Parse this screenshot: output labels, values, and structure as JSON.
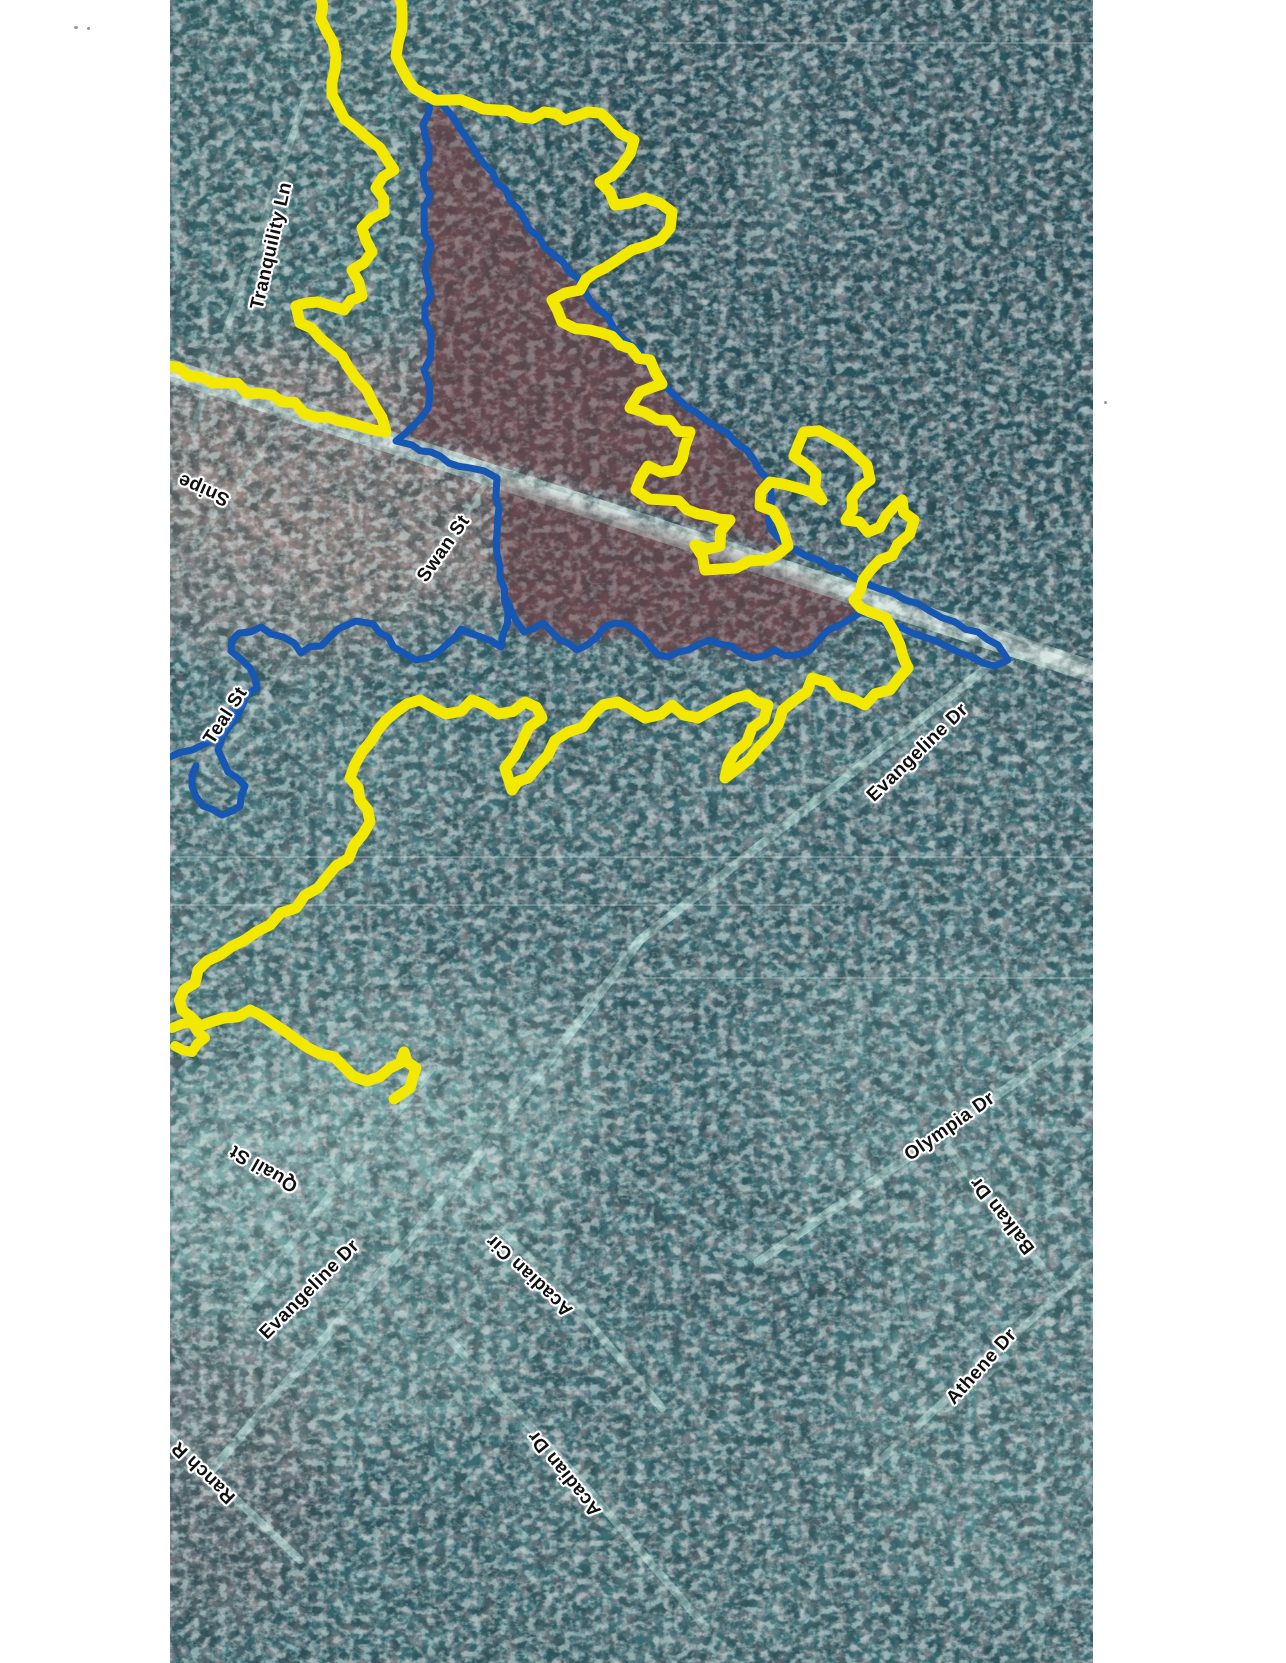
{
  "page": {
    "background": "#ffffff"
  },
  "map": {
    "area": {
      "left": 170,
      "top": 0,
      "width": 923,
      "height": 1663
    },
    "colors": {
      "outer_boundary_yellow": "#f3e800",
      "inner_boundary_blue": "#1557b2",
      "base_teal": "#33626a",
      "dark_forest": "#26505a",
      "burn_region_brown": "#6b4a50",
      "road_light": "#b7cec9",
      "road_bright": "#d9e6e1",
      "label_text": "#101010",
      "label_halo": "#ffffff"
    },
    "street_labels": [
      {
        "id": "tranquility-ln",
        "text": "Tranquility Ln",
        "x": 272,
        "y": 246,
        "rot": -77
      },
      {
        "id": "snipe",
        "text": "Snipe",
        "x": 204,
        "y": 489,
        "rot": -156
      },
      {
        "id": "swan-st",
        "text": "Swan St",
        "x": 444,
        "y": 549,
        "rot": -55
      },
      {
        "id": "teal-st",
        "text": "Teal St",
        "x": 226,
        "y": 716,
        "rot": -57
      },
      {
        "id": "evangeline-dr-upper",
        "text": "Evangeline Dr",
        "x": 918,
        "y": 753,
        "rot": -44
      },
      {
        "id": "quail-st",
        "text": "Quail St",
        "x": 264,
        "y": 1168,
        "rot": -150
      },
      {
        "id": "evangeline-dr-lower",
        "text": "Evangeline Dr",
        "x": 310,
        "y": 1290,
        "rot": -45
      },
      {
        "id": "acadian-cir",
        "text": "Acadian Cir",
        "x": 530,
        "y": 1275,
        "rot": -137
      },
      {
        "id": "olympia-dr",
        "text": "Olympia Dr",
        "x": 950,
        "y": 1127,
        "rot": -35
      },
      {
        "id": "balkan-dr",
        "text": "Balkan Dr",
        "x": 1003,
        "y": 1215,
        "rot": -128
      },
      {
        "id": "athene-dr",
        "text": "Athene Dr",
        "x": 982,
        "y": 1367,
        "rot": -48
      },
      {
        "id": "acadian-dr",
        "text": "Acadian Dr",
        "x": 565,
        "y": 1473,
        "rot": -129
      },
      {
        "id": "ranch-r",
        "text": "Ranch R",
        "x": 204,
        "y": 1472,
        "rot": -136
      }
    ]
  }
}
